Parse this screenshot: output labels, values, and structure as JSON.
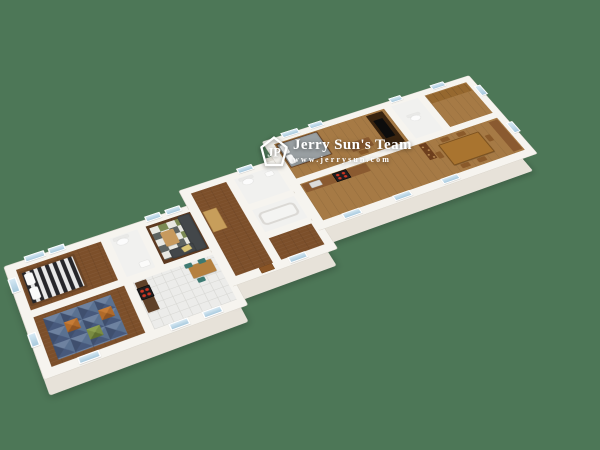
{
  "scene": {
    "description": "3D isometric architectural rendering of a long multi-unit apartment floor plan, viewed from above at an angle",
    "background_color": "#4d7757"
  },
  "watermark": {
    "logo_monogram": "JP",
    "team_name": "Jerry Sun's Team",
    "website": "www.jerrysun.com"
  },
  "colors": {
    "bg": "#4d7757",
    "wall": "#f6f4ef",
    "wallEdge": "#d9d4ca",
    "slab": "#e7e2d9",
    "woodDark": "#5e3a20",
    "woodMid": "#7c4f2a",
    "woodLight": "#a67a45",
    "woodPale": "#c79e5b",
    "tile": "#ececea",
    "tileLine": "#d8d8d4",
    "glass": "#a9cade",
    "glassHi": "#d6e9f4",
    "rugGreen": "#7b8a54",
    "rugWhite": "#e8e8e2",
    "rugGray": "#5d6361",
    "kidBlue1": "#5a7191",
    "kidBlue2": "#47597c",
    "kidOrange": "#b06a2a",
    "kidGreen": "#7a8c42",
    "stripeDark": "#26262a",
    "stripeLight": "#e8e8e8",
    "sofa": "#43474a",
    "cushion": "#d9c474",
    "counterDark": "#5f4129",
    "stove": "#1d1d1f",
    "burner": "#d03522",
    "teal": "#3e7a72",
    "tableWood": "#b5803f",
    "tableBig": "#a9742f",
    "darkFurn": "#38230f",
    "tv": "#0c0c0c",
    "blanket": "#9aa0a3",
    "cabinet": "#8a5a30",
    "cabinetLight": "#96682f",
    "door": "#8a5526"
  },
  "rooms": [
    {
      "name": "bedroom-left",
      "floor": "wood",
      "furniture": [
        "bed-striped-duvet",
        "pillows"
      ]
    },
    {
      "name": "bathroom-left",
      "floor": "white",
      "fixtures": [
        "toilet",
        "sink"
      ]
    },
    {
      "name": "living-room",
      "floor": "dark-wood",
      "furniture": [
        "gray-l-sofa",
        "yellow-cushion",
        "coffee-table",
        "green-white-checker-rug"
      ]
    },
    {
      "name": "kids-room",
      "floor": "wood",
      "furniture": [
        "blue-orange-green-triangle-rug"
      ]
    },
    {
      "name": "kitchen-left",
      "floor": "white-tile",
      "furniture": [
        "counter",
        "stove-red-burners",
        "dining-table",
        "teal-chairs"
      ]
    },
    {
      "name": "hallway-middle",
      "floor": "wood",
      "furniture": [
        "wardrobe"
      ]
    },
    {
      "name": "bathroom-middle",
      "floor": "white",
      "fixtures": [
        "toilet",
        "sink"
      ]
    },
    {
      "name": "bathroom-middle-2",
      "floor": "white",
      "fixtures": [
        "bathtub"
      ]
    },
    {
      "name": "entry-middle",
      "floor": "wood"
    },
    {
      "name": "bedroom-right",
      "floor": "wood",
      "furniture": [
        "gray-bed",
        "desk",
        "chair",
        "tv-wardrobe"
      ]
    },
    {
      "name": "bathroom-right",
      "floor": "white",
      "fixtures": [
        "toilet"
      ]
    },
    {
      "name": "closet-right",
      "floor": "wood",
      "furniture": [
        "cabinets"
      ]
    },
    {
      "name": "kitchen-dining-right",
      "floor": "wood",
      "furniture": [
        "counter",
        "sink",
        "stove-red-burners",
        "pantry-shelf",
        "large-dining-table",
        "chairs",
        "tall-cabinet"
      ]
    }
  ]
}
